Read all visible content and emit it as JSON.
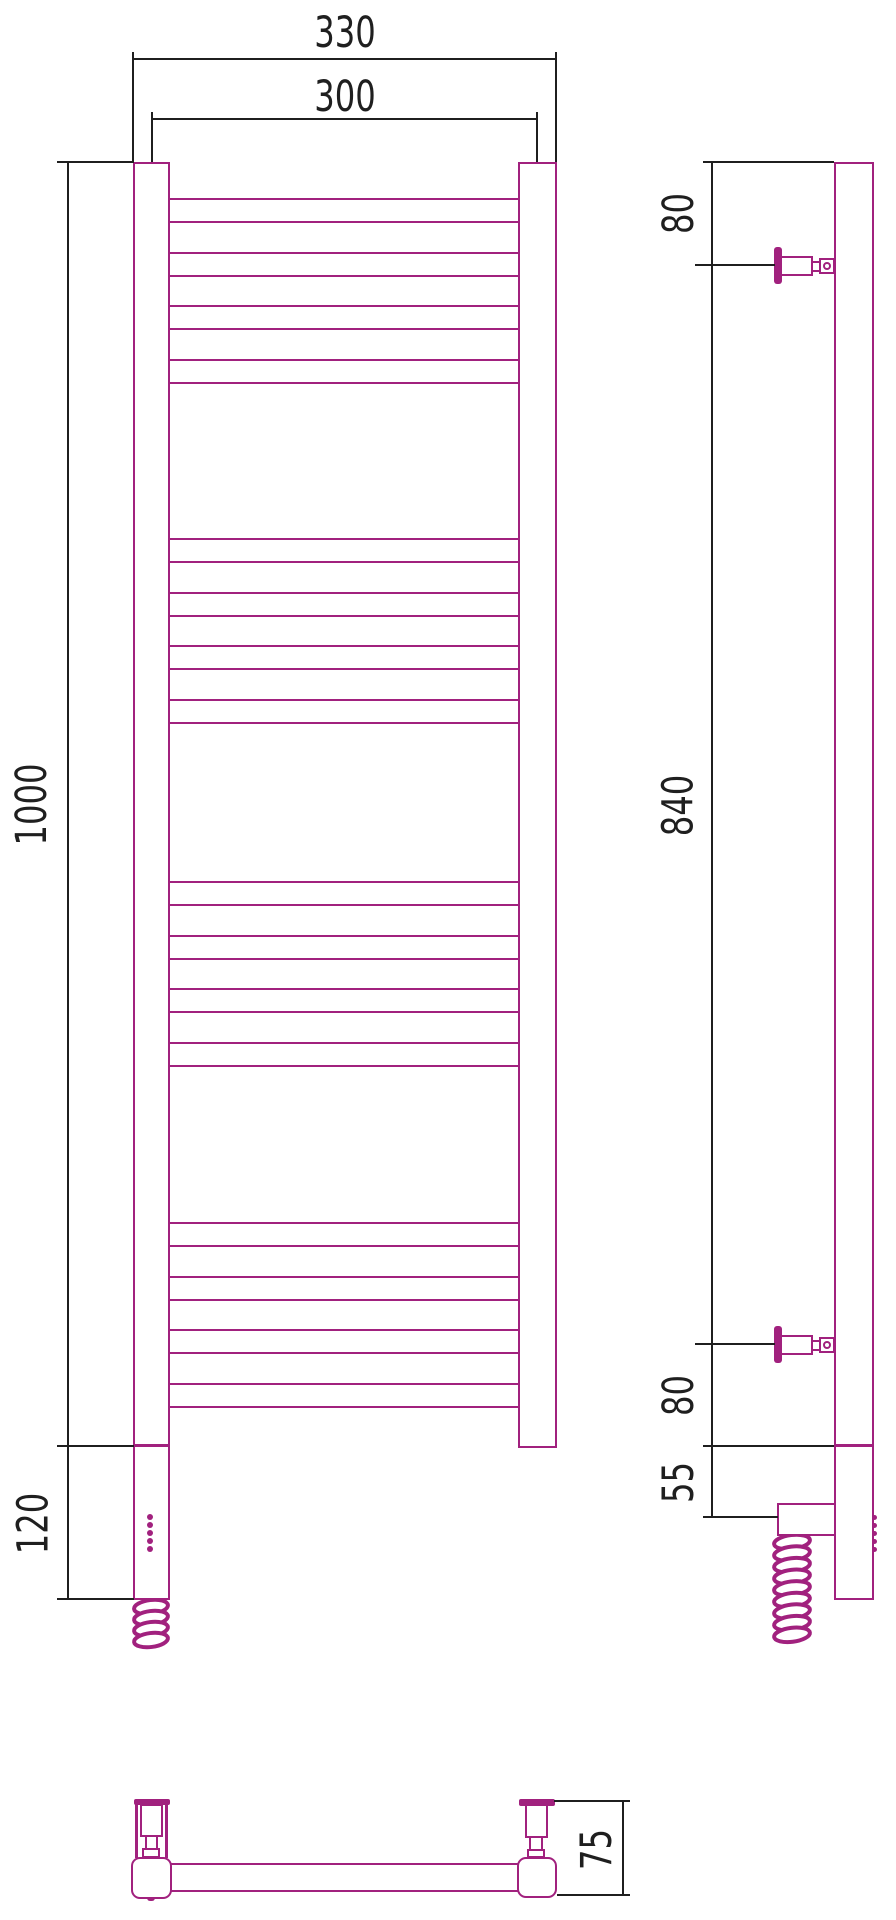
{
  "drawing": {
    "kind": "towel-rail-technical-drawing",
    "views": {
      "front": "front-view",
      "side": "side-view",
      "bottom": "bottom-view"
    }
  },
  "dimensions": {
    "front_view": {
      "overall_width": "330",
      "center_spacing": "300",
      "overall_height": "1000",
      "lower_section": "120"
    },
    "side_view": {
      "top_offset": "80",
      "bracket_span": "840",
      "bottom_offset": "80",
      "element_section": "55"
    },
    "bottom_view": {
      "depth": "75"
    }
  },
  "structure": {
    "rung_groups": 4,
    "rungs_per_group": 4,
    "rung_count": 16,
    "indicator_dot_count": 5,
    "front_coil_loops": 4,
    "side_coil_loops": 9
  },
  "colors": {
    "product_outline": "#A1217E",
    "dimension_lines": "#1F1F1F",
    "background": "#FFFFFF"
  }
}
